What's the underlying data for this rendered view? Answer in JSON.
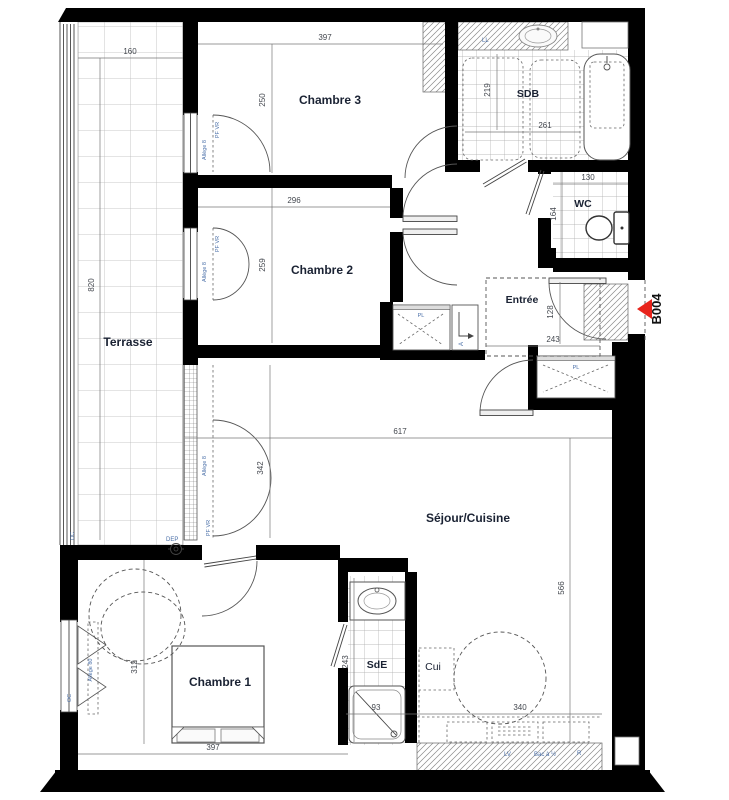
{
  "plan": {
    "unit_id": "B004",
    "rooms": {
      "terrasse": {
        "label": "Terrasse",
        "dims": {
          "w": "160",
          "h": "820"
        }
      },
      "chambre3": {
        "label": "Chambre 3",
        "dims": {
          "w": "397",
          "h": "250"
        }
      },
      "chambre2": {
        "label": "Chambre 2",
        "dims": {
          "w": "296",
          "h": "259"
        }
      },
      "sdb": {
        "label": "SDB",
        "dims": {
          "w": "261",
          "h": "219"
        }
      },
      "wc": {
        "label": "WC",
        "dims": {
          "w": "130",
          "h": "164"
        }
      },
      "entree": {
        "label": "Entrée",
        "dims": {
          "w": "243",
          "h": "128"
        }
      },
      "sejour": {
        "label": "Séjour/Cuisine",
        "dims": {
          "w": "617",
          "h": "566",
          "bay": "342"
        }
      },
      "chambre1": {
        "label": "Chambre 1",
        "dims": {
          "w": "397",
          "h": "312"
        }
      },
      "sde": {
        "label": "SdE",
        "dims": {
          "w": "93",
          "h": "243"
        }
      },
      "cuisine": {
        "label": "Cui",
        "dims": {
          "w": "340"
        }
      }
    },
    "annotations": {
      "washing_machine": "LL",
      "closet": "PL",
      "dishwasher": "LV",
      "half_sink": "Bac à ½",
      "fridge": "R",
      "floor_drain": "DEP",
      "window_oc": "OC",
      "window_pf": "PF VR",
      "sill_8": "Allège 8",
      "sill_80": "Allège 80",
      "duct": "A"
    },
    "colors": {
      "wall": "#000000",
      "marker_red": "#e8241c",
      "room_label": "#1a2233",
      "dim_label": "#44484f",
      "note_label": "#4a6fa8"
    }
  }
}
